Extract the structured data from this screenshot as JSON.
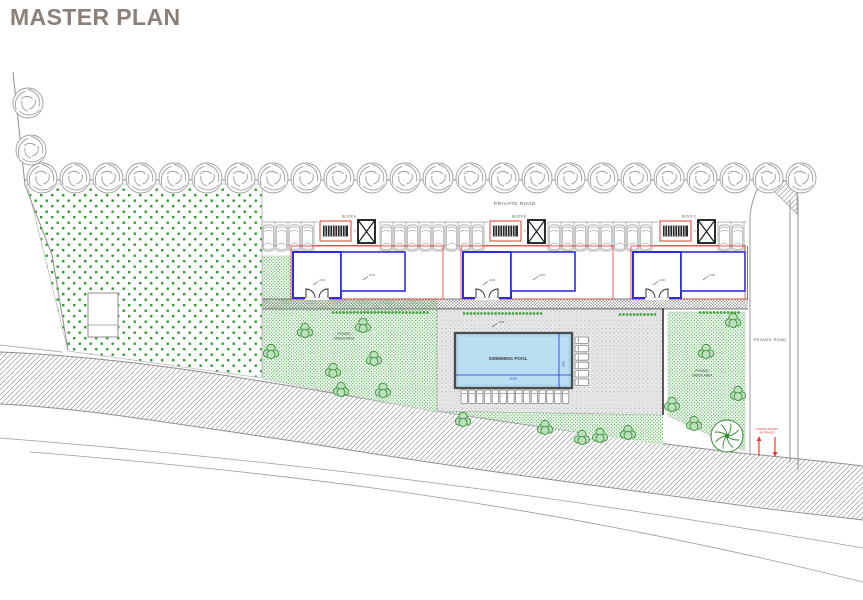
{
  "title": "MASTER PLAN",
  "colors": {
    "title": "#8a8078",
    "boundary": "#8f8f8f",
    "tree": "#9d9d9d",
    "green_dot": "#2f9e2f",
    "bush_stroke": "#2e8b2e",
    "bush_fill": "#bcdfbc",
    "wall_blue": "#2e2ee0",
    "plan_red": "#e23b2e",
    "pool_water": "#badff2",
    "pool_rim": "#4d4d4d",
    "deck_bg": "#e8e8e8",
    "deck_dot": "#a5a5a5",
    "car": "#adadad",
    "hatch": "#9b9b9b",
    "text_dark": "#4a4a4a",
    "dim_blue": "#2233cc"
  },
  "labels": {
    "private_road_top": "PRIVATE ROAD",
    "private_road_right": "PRIVATE ROAD",
    "green_l1": "PRIVATE",
    "green_l2": "GREEN AREA",
    "swimming_pool": "SWIMMING POOL",
    "pool_dim_w": "15.00",
    "pool_dim_h": "5.00",
    "entrance_l1": "PRIVATE ROAD'S",
    "entrance_l2": "ENTRANCE",
    "level_marker": "+0.00"
  },
  "block_sublabel": "a",
  "blocks": [
    {
      "label": "BLOCK A",
      "x": 293
    },
    {
      "label": "BLOCK B",
      "x": 463
    },
    {
      "label": "BLOCK C",
      "x": 633
    }
  ],
  "trees": {
    "row": {
      "y": 178,
      "start_x": 42,
      "spacing": 33,
      "count": 24
    },
    "extra": [
      [
        28,
        103
      ],
      [
        31,
        150
      ]
    ]
  },
  "parking": {
    "top": 222,
    "bottom": 251,
    "stall_width": 13,
    "ranges": [
      [
        262,
        318
      ],
      [
        380,
        488
      ],
      [
        548,
        658
      ],
      [
        718,
        746
      ]
    ]
  },
  "bushes": {
    "left": [
      [
        305,
        331
      ],
      [
        271,
        352
      ],
      [
        333,
        371
      ],
      [
        363,
        326
      ],
      [
        374,
        359
      ],
      [
        383,
        391
      ],
      [
        341,
        390
      ]
    ],
    "right": [
      [
        463,
        420
      ],
      [
        545,
        428
      ],
      [
        600,
        436
      ],
      [
        628,
        433
      ],
      [
        672,
        405
      ],
      [
        694,
        424
      ],
      [
        706,
        352
      ],
      [
        733,
        321
      ],
      [
        738,
        394
      ],
      [
        582,
        438
      ]
    ],
    "big_tree": [
      727,
      436
    ]
  },
  "hedges": [
    [
      333,
      311,
      95
    ],
    [
      464,
      312,
      78
    ],
    [
      620,
      313,
      38
    ],
    [
      700,
      311,
      40
    ]
  ],
  "loungers": {
    "right_col": {
      "x": 575,
      "y": 337,
      "count": 6,
      "dy": 8.4
    },
    "bottom_row": {
      "x": 461,
      "y": 390,
      "count": 14,
      "dx": 7.8
    }
  },
  "pool": {
    "x": 455,
    "y": 333,
    "w": 117,
    "h": 55
  }
}
